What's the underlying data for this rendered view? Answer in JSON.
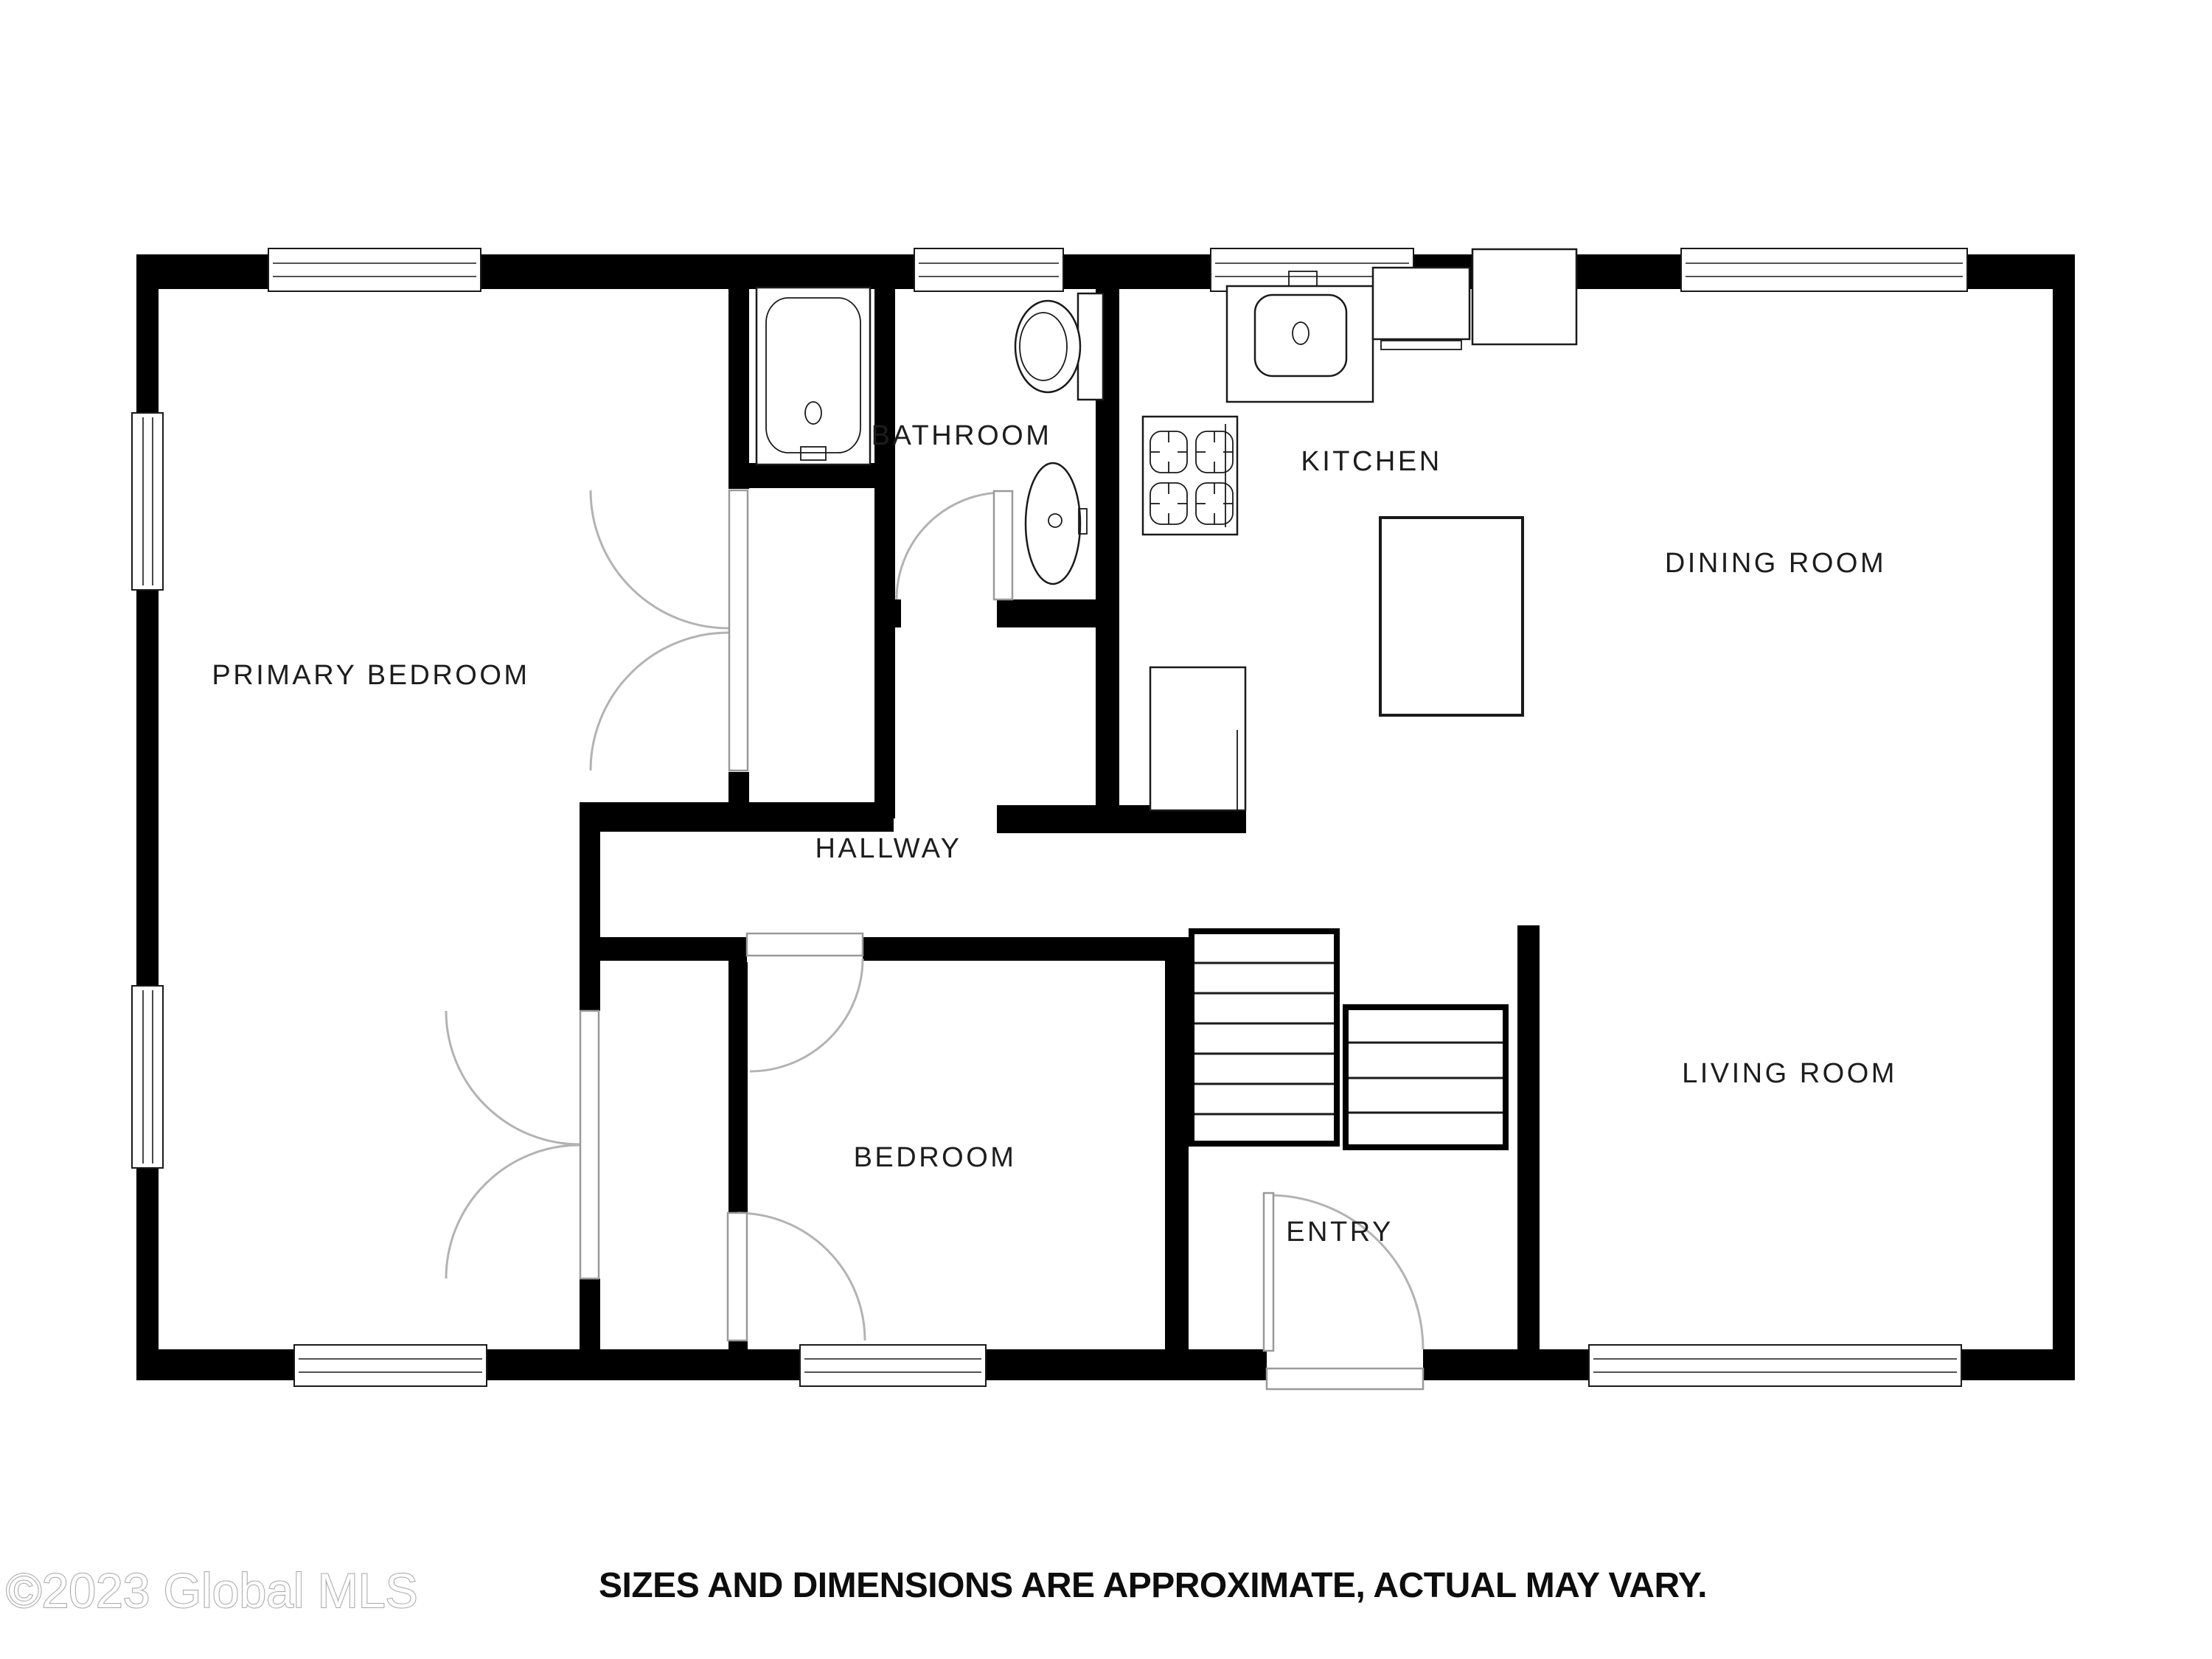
{
  "plan": {
    "wall_color": "#000000",
    "fixture_line_color": "#1a1a1a",
    "door_arc_color": "#b3b3b3",
    "rooms": [
      {
        "name": "primary-bedroom",
        "label": "PRIMARY BEDROOM"
      },
      {
        "name": "bathroom",
        "label": "BATHROOM"
      },
      {
        "name": "kitchen",
        "label": "KITCHEN"
      },
      {
        "name": "dining-room",
        "label": "DINING ROOM"
      },
      {
        "name": "hallway",
        "label": "HALLWAY"
      },
      {
        "name": "bedroom",
        "label": "BEDROOM"
      },
      {
        "name": "entry",
        "label": "ENTRY"
      },
      {
        "name": "living-room",
        "label": "LIVING ROOM"
      }
    ],
    "fixtures": [
      "bathtub",
      "toilet",
      "bathroom-sink",
      "kitchen-sink-counter",
      "dishwasher",
      "cabinet",
      "stove",
      "lower-cabinet",
      "island",
      "stairs-upper-run",
      "stairs-lower-run"
    ]
  },
  "footer": {
    "watermark": "©2023 Global MLS",
    "disclaimer": "SIZES AND DIMENSIONS ARE APPROXIMATE, ACTUAL MAY VARY."
  }
}
